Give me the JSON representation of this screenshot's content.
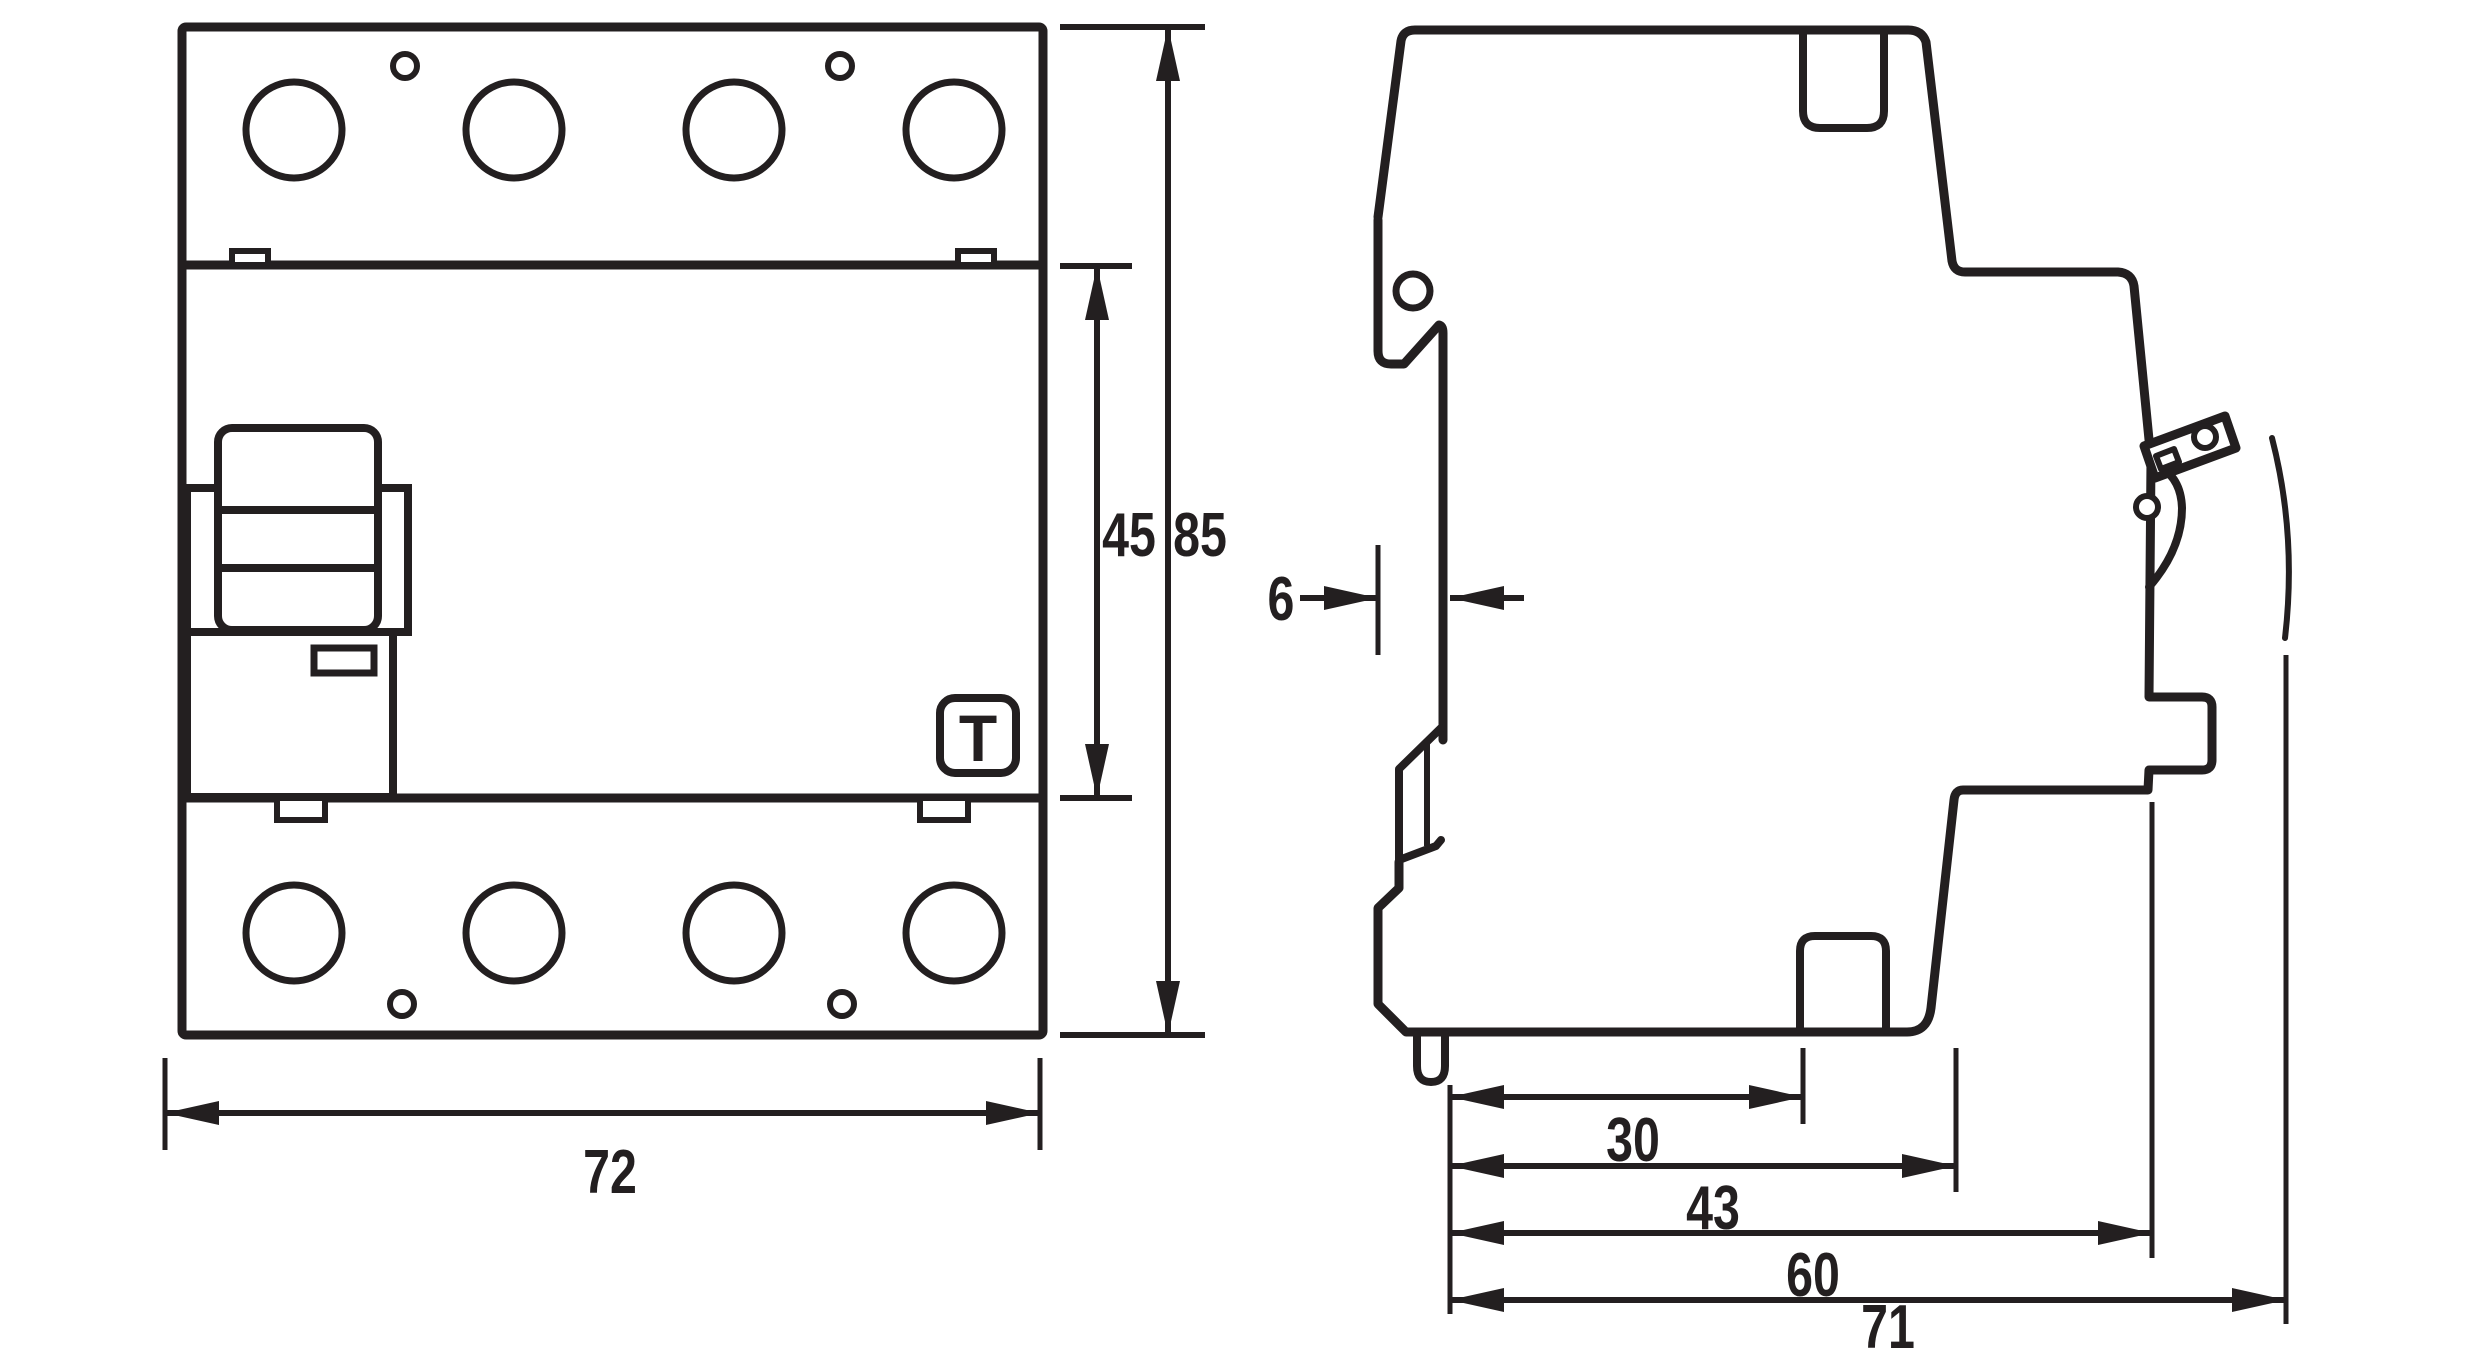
{
  "logo": {
    "letter": "T"
  },
  "dimensions": {
    "front": {
      "width": "72",
      "inner_height": "45",
      "total_height": "85"
    },
    "side": {
      "rail_recess_depth": "6",
      "rear_to_rail_guide": "30",
      "rear_to_body_front": "43",
      "rear_to_front_panel": "60",
      "total_depth": "71"
    }
  }
}
